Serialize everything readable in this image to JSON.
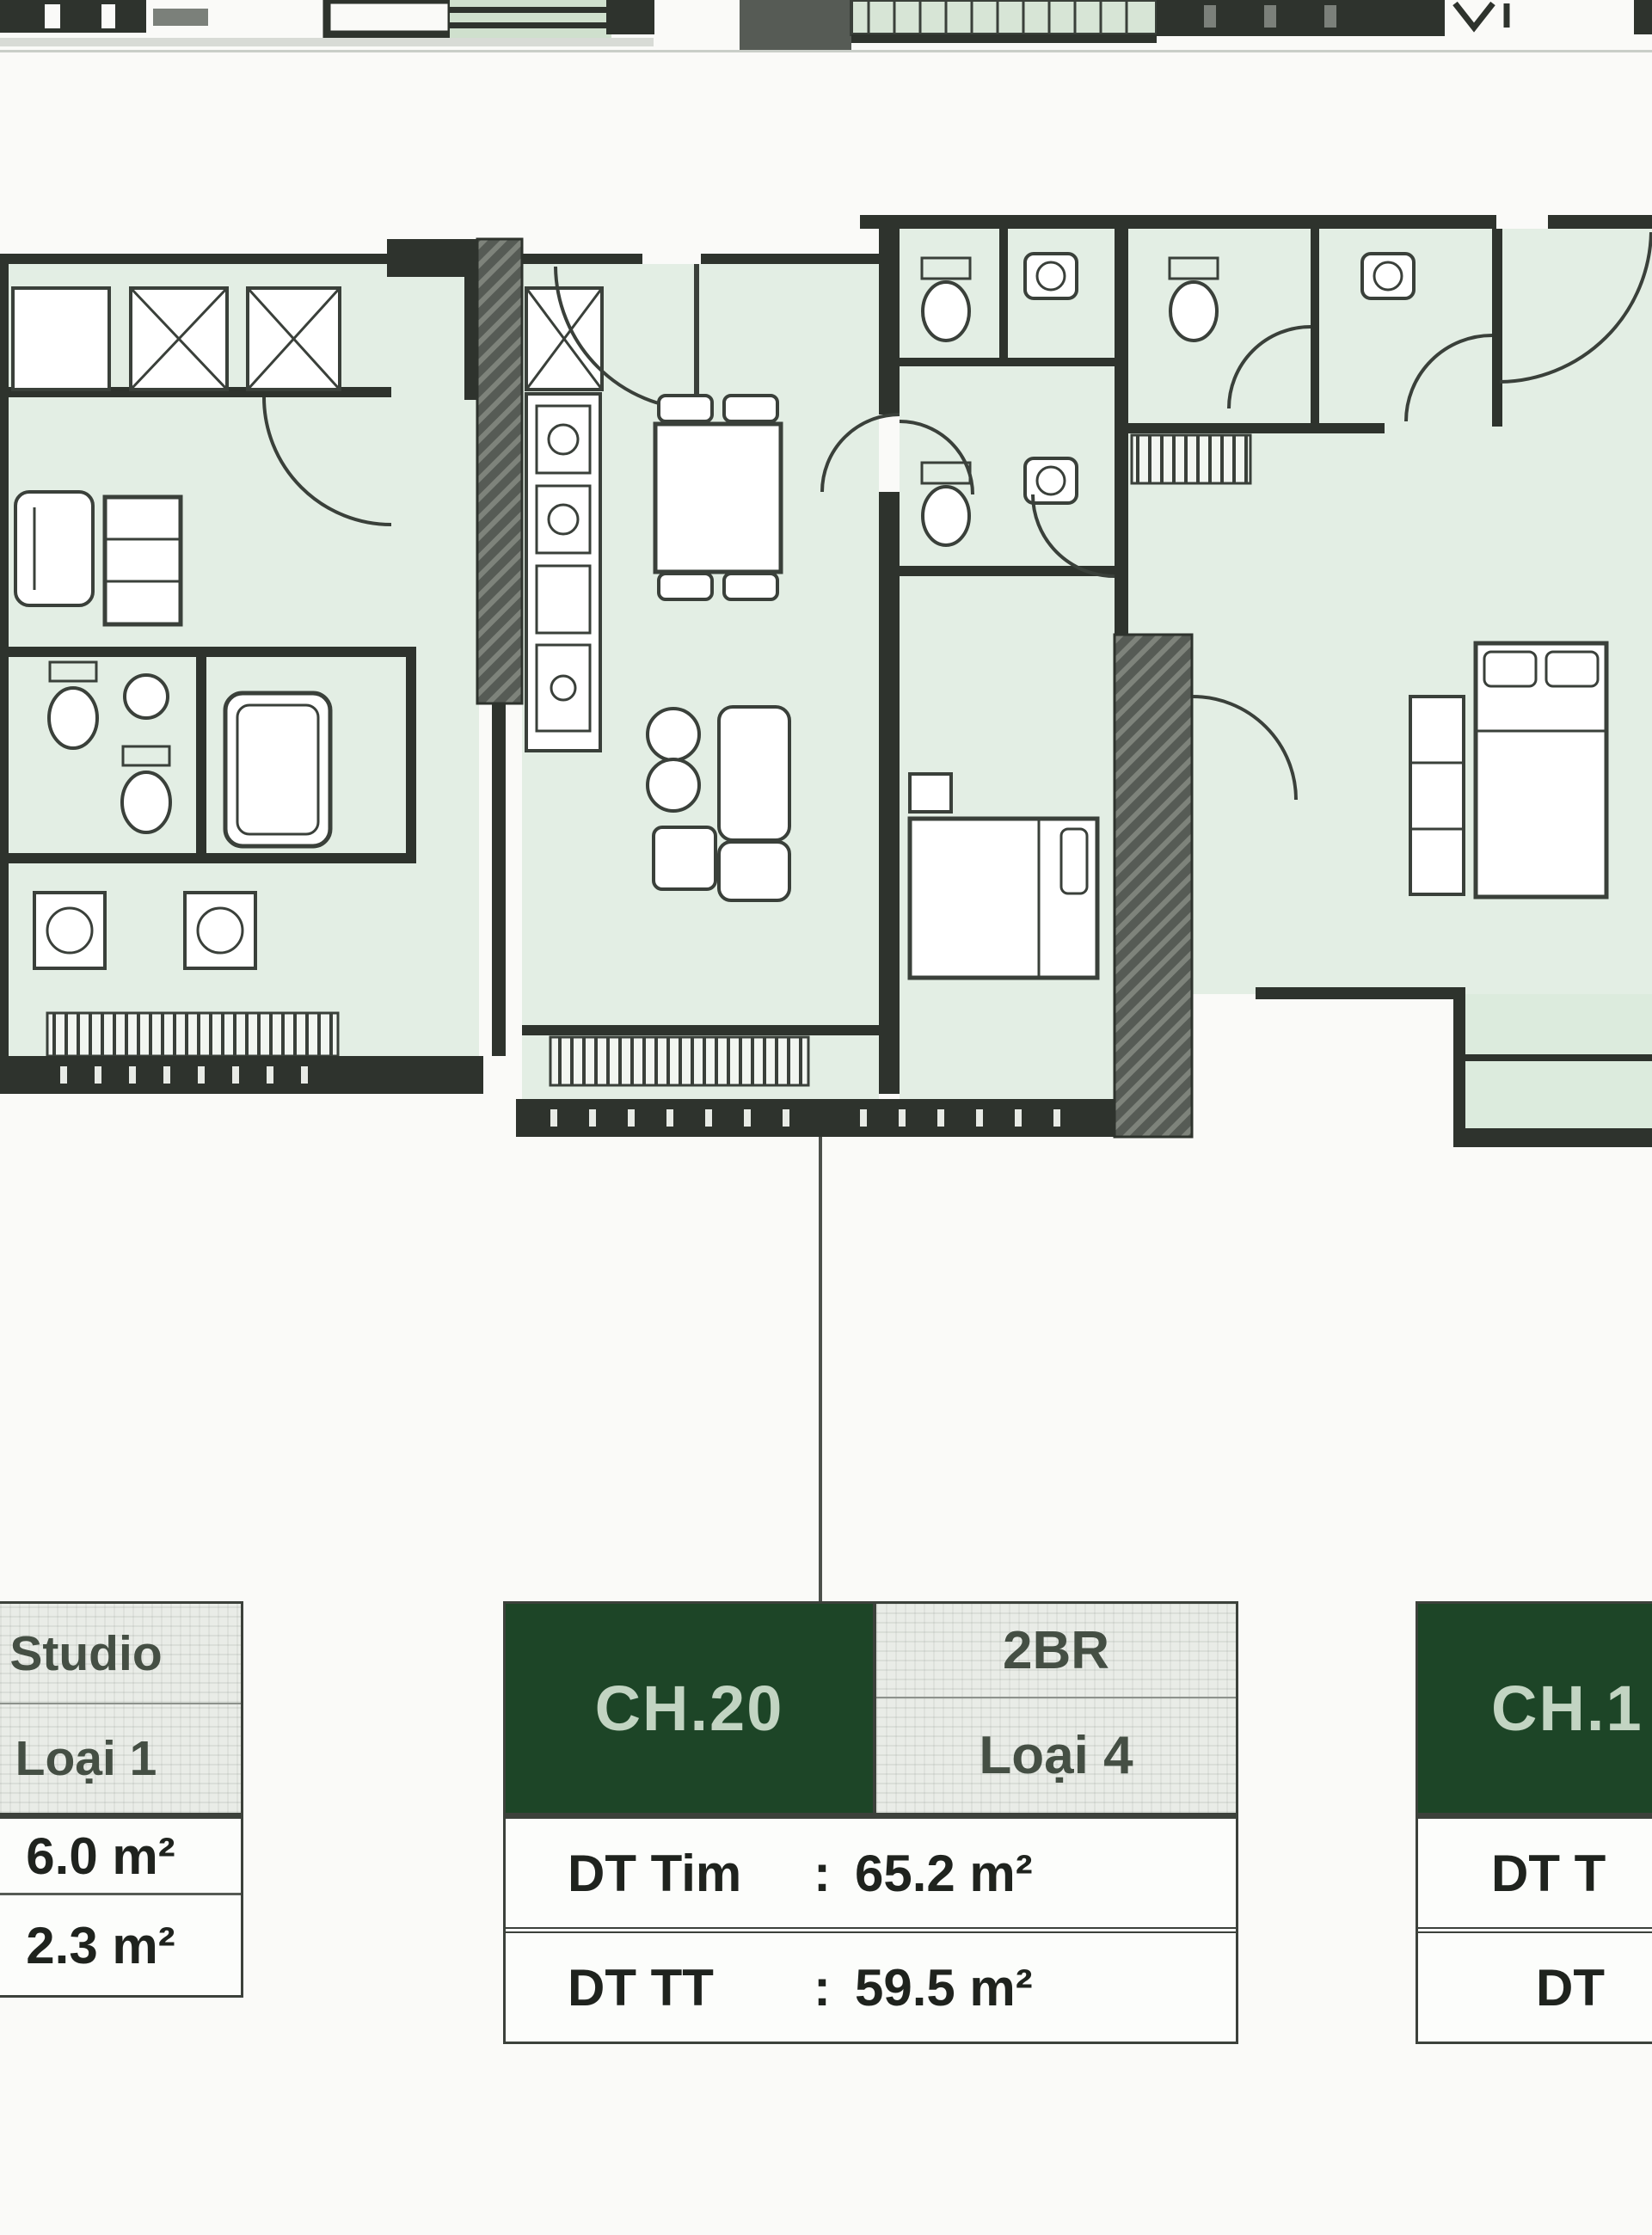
{
  "palette": {
    "header_green": "#1d4527",
    "header_green_text": "#c2d4c2",
    "type_cell_bg": "#e9ece7",
    "type_cell_text": "#454f44",
    "value_text": "#1f231e",
    "table_border": "#3c413b",
    "floor_mint": "#e3eee4",
    "wall_dark": "#2e332d",
    "hatch_gray": "#565b55",
    "leader_line": "#4c504b"
  },
  "tables": {
    "left": {
      "type_line1": "Studio",
      "type_line2": "Loại 1",
      "row1_value": "6.0 m²",
      "row2_value": "2.3 m²"
    },
    "middle": {
      "unit": "CH.20",
      "type_line1": "2BR",
      "type_line2": "Loại 4",
      "row1_label": "DT Tim",
      "row1_colon": ":",
      "row1_value": "65.2 m²",
      "row2_label": "DT TT",
      "row2_colon": ":",
      "row2_value": "59.5 m²"
    },
    "right": {
      "unit": "CH.1",
      "row1_label": "DT T",
      "row2_label": "DT"
    }
  }
}
